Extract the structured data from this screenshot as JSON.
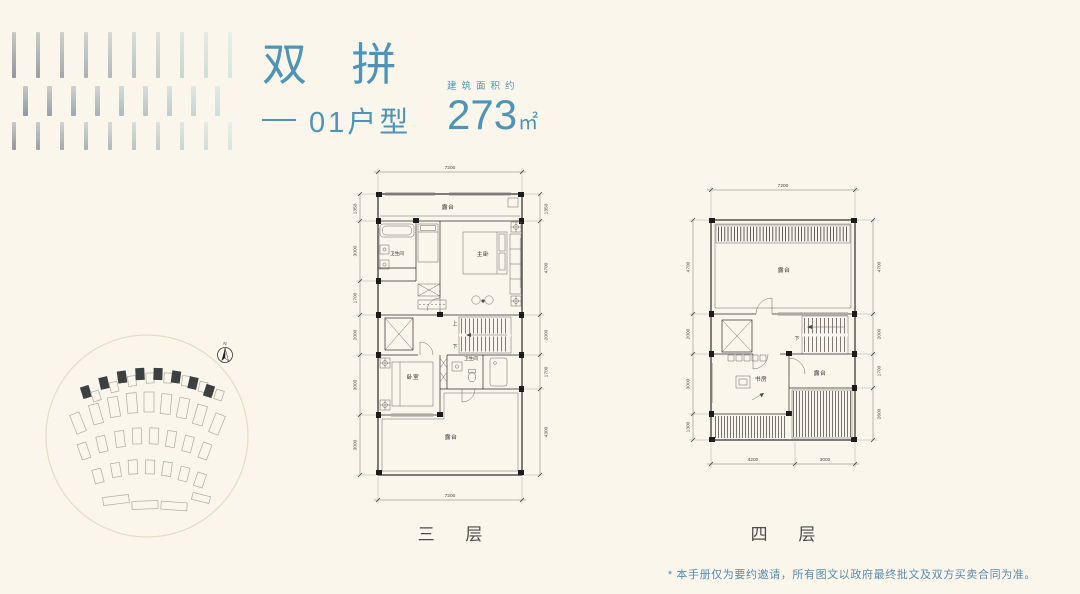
{
  "theme": {
    "background": "#FAF6EB",
    "accent": "#4F94B6",
    "plan_line": "#2b2b2b",
    "dim_text": "#4a4a4a",
    "disclaimer_text": "#5a8cab"
  },
  "header": {
    "title": "双 拼",
    "unit": "01户型",
    "area_label": "建筑面积约",
    "area_value": "273",
    "area_unit": "㎡"
  },
  "floor3": {
    "name": "三 层",
    "dim_top": "7200",
    "dim_bottom": "7200",
    "dims_left": [
      "1350",
      "3000",
      "1700",
      "2000",
      "3000",
      "3000"
    ],
    "dims_right": [
      "1350",
      "4700",
      "2000",
      "1700",
      "4300"
    ],
    "rooms": {
      "terrace_top": "露台",
      "bathroom_upper": "卫生间",
      "master_bedroom": "主卧",
      "bedroom": "卧室",
      "bathroom_lower": "卫生间",
      "terrace_bottom": "露台"
    },
    "stairs_up": "上",
    "stairs_down": "下"
  },
  "floor4": {
    "name": "四 层",
    "dim_top": "7200",
    "dims_bottom": [
      "4200",
      "3000"
    ],
    "dims_left": [
      "4700",
      "2000",
      "3000",
      "1300"
    ],
    "dims_right": [
      "4700",
      "2000",
      "1700",
      "2600"
    ],
    "rooms": {
      "terrace_top": "露台",
      "study": "书房",
      "terrace_side": "露台"
    },
    "stairs_down": "下"
  },
  "siteplan": {
    "north_label": "N"
  },
  "footer": {
    "disclaimer": "* 本手册仅为要约邀请，所有图文以政府最终批文及双方买卖合同为准。"
  }
}
